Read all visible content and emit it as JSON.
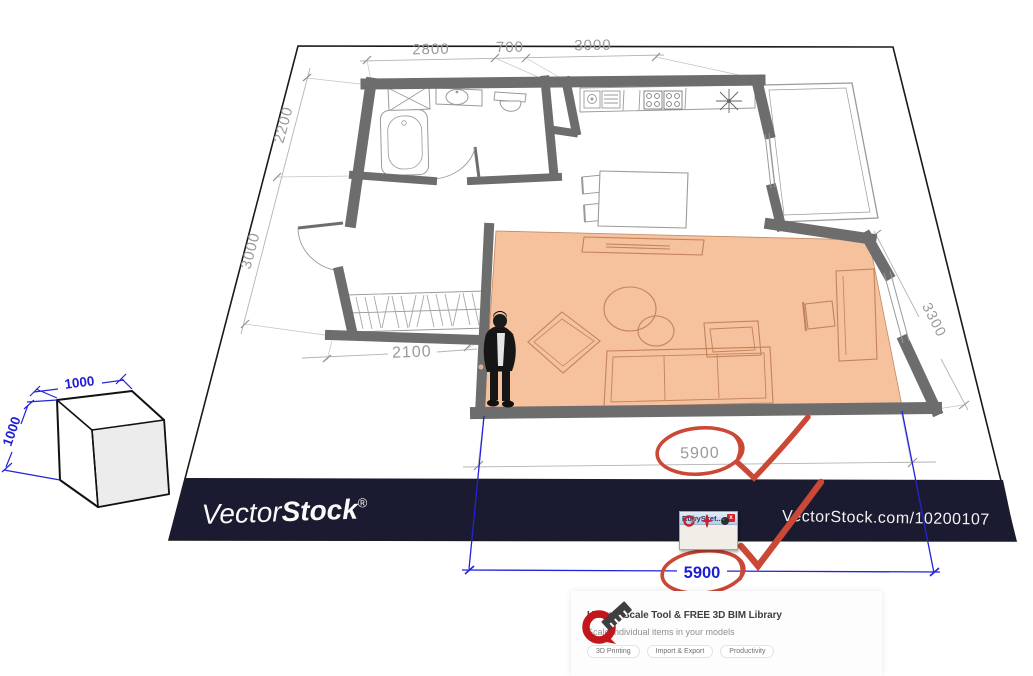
{
  "plan": {
    "dims": {
      "top": [
        "2800",
        "700",
        "3000"
      ],
      "left": [
        "2200",
        "3000"
      ],
      "closet": "2100",
      "balcony": "3200",
      "right": "3300",
      "overall": "5900"
    }
  },
  "overlay": {
    "blue_overall": "5900",
    "cube_width": "1000",
    "cube_height": "1000"
  },
  "watermark": {
    "brand_a": "Vector",
    "brand_b": "Stock",
    "reg": "®",
    "url": "VectorStock.com/10200107"
  },
  "ruby_window": {
    "title": "RubySket...",
    "close_label": "x"
  },
  "banner": {
    "title": "Unique Scale Tool & FREE 3D BIM Library",
    "subtitle": "Scale individual items in your models",
    "tags": [
      "3D Printing",
      "Import & Export",
      "Productivity"
    ]
  },
  "colors": {
    "annotation_red": "#cb4736",
    "dimension_blue": "#2323d9",
    "watermark_navy": "#1a1b30",
    "room_highlight": "#f6c19d",
    "wall_gray": "#6d6d6d"
  }
}
